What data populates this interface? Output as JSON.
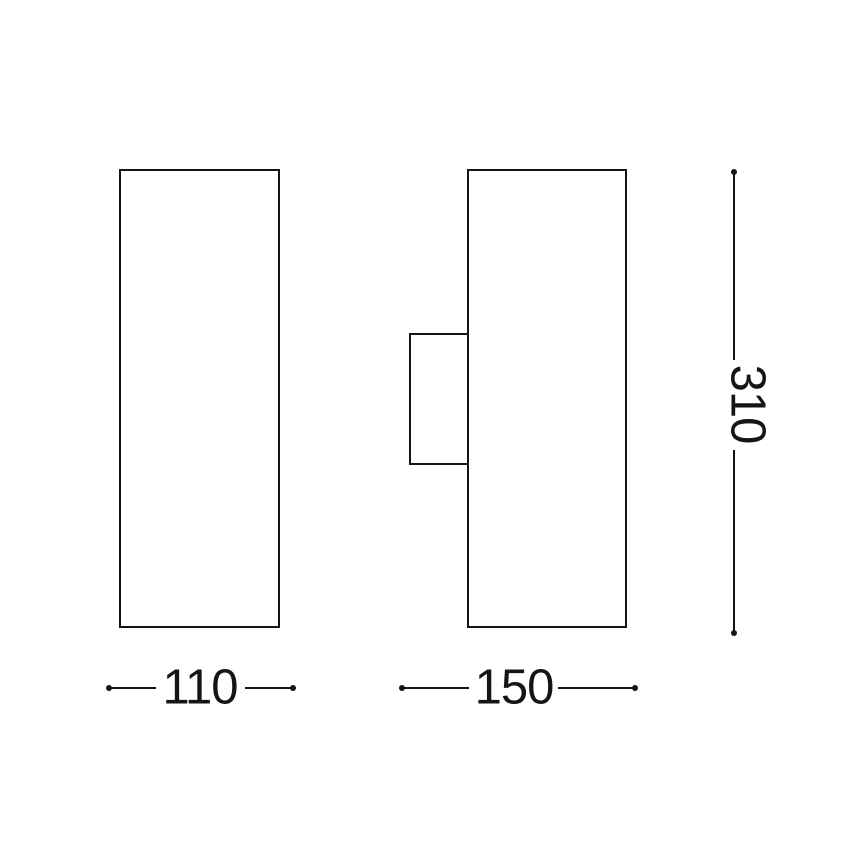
{
  "diagram": {
    "background_color": "#ffffff",
    "line_color": "#151515",
    "dimensions": {
      "front_width": {
        "label": "110"
      },
      "side_width": {
        "label": "150"
      },
      "height": {
        "label": "310"
      }
    }
  }
}
